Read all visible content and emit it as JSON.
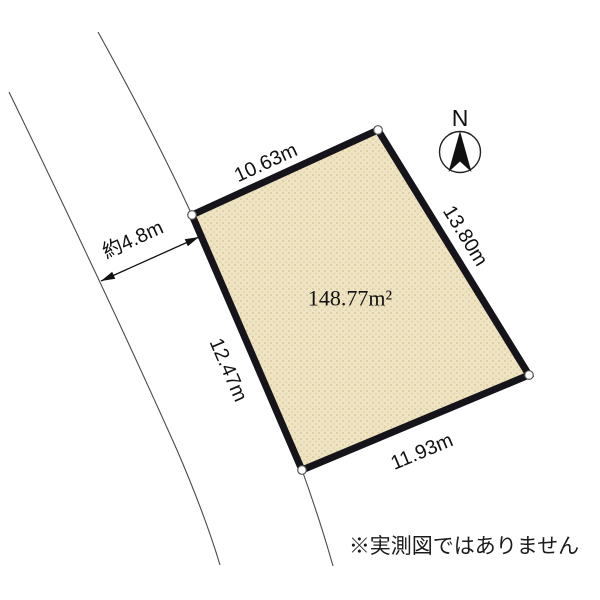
{
  "diagram": {
    "type": "land-plot-survey-sketch",
    "parcel": {
      "area_label": "148.77m²",
      "edge_labels": {
        "top": "10.63m",
        "right": "13.80m",
        "bottom": "11.93m",
        "left": "12.47m"
      },
      "fill_color": "#eee3c3",
      "fill_speckle_color_1": "#e0d0a4",
      "fill_speckle_color_2": "#e6d7ae",
      "border_color": "#14141a",
      "vertex_marker": "white-circle"
    },
    "road": {
      "width_label": "約4.8m",
      "line_color": "#4a4a4a"
    },
    "compass": {
      "label": "N",
      "needle_color": "#111111"
    },
    "disclaimer_text": "※実測図ではありません",
    "background_color": "#ffffff",
    "text_color": "#111111"
  }
}
